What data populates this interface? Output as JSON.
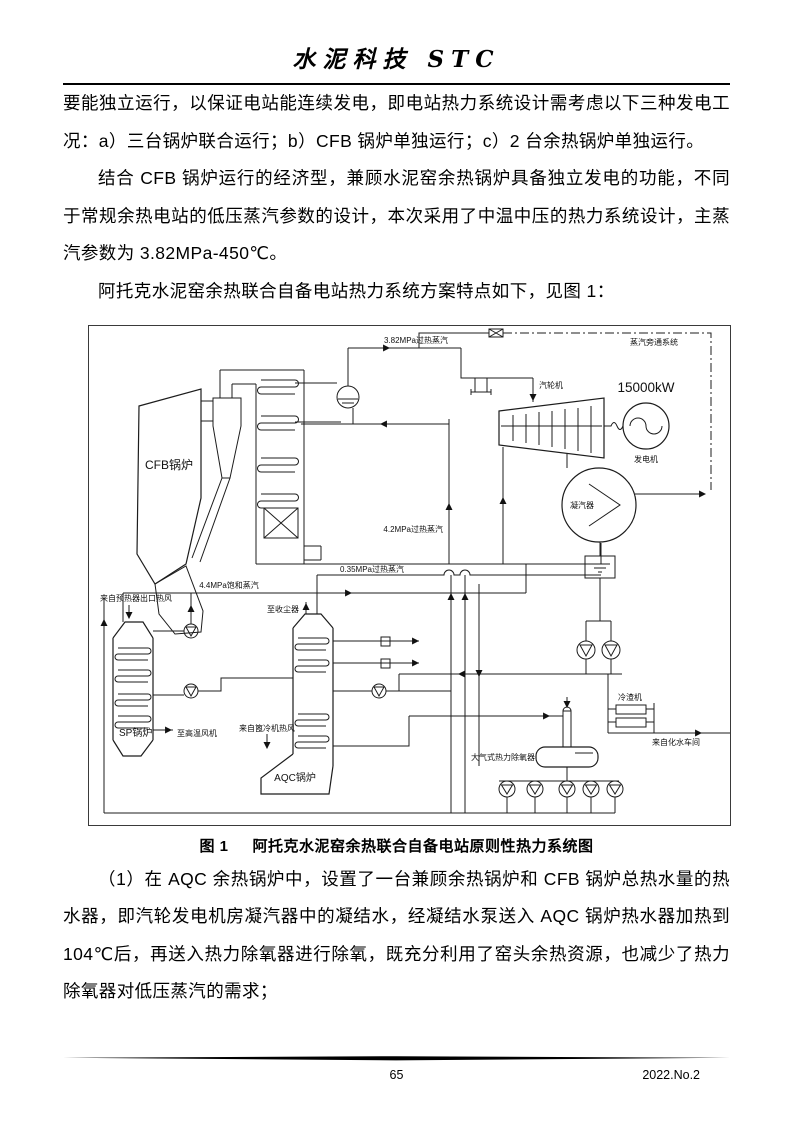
{
  "page": {
    "header_title": "水泥科技 STC",
    "footer_page_number": "65",
    "footer_issue": "2022.No.2"
  },
  "paragraphs": {
    "p1": "要能独立运行，以保证电站能连续发电，即电站热力系统设计需考虑以下三种发电工况：a）三台锅炉联合运行；b）CFB 锅炉单独运行；c）2 台余热锅炉单独运行。",
    "p2": "结合 CFB 锅炉运行的经济型，兼顾水泥窑余热锅炉具备独立发电的功能，不同于常规余热电站的低压蒸汽参数的设计，本次采用了中温中压的热力系统设计，主蒸汽参数为 3.82MPa-450℃。",
    "p3": "阿托克水泥窑余热联合自备电站热力系统方案特点如下，见图 1：",
    "p4": "（1）在 AQC 余热锅炉中，设置了一台兼顾余热锅炉和 CFB 锅炉总热水量的热水器，即汽轮发电机房凝汽器中的凝结水，经凝结水泵送入 AQC 锅炉热水器加热到 104℃后，再送入热力除氧器进行除氧，既充分利用了窑头余热资源，也减少了热力除氧器对低压蒸汽的需求；"
  },
  "figure": {
    "caption_label": "图 1",
    "caption_title": "阿托克水泥窑余热联合自备电站原则性热力系统图",
    "labels": {
      "main_steam": "3.82MPa过热蒸汽",
      "bypass_system": "蒸汽旁通系统",
      "turbine": "汽轮机",
      "generator_power": "15000kW",
      "generator": "发电机",
      "condenser": "凝汽器",
      "mp_steam": "4.2MPa过热蒸汽",
      "lp_steam": "0.35MPa过热蒸汽",
      "sat_steam": "4.4MPa饱和蒸汽",
      "cfb_boiler": "CFB锅炉",
      "sp_boiler": "SP锅炉",
      "aqc_boiler": "AQC锅炉",
      "from_preheater": "来自预热器出口热风",
      "to_ht_fan": "至高温风机",
      "to_dust_collector": "至收尘器",
      "from_grate_cooler": "来自篦冷机热风",
      "slag_cooler": "冷渣机",
      "from_water_plant": "来自化水车间",
      "deaerator": "大气式热力除氧器"
    },
    "colors": {
      "line": "#1c1c1c",
      "border": "#3a3a3a"
    }
  }
}
